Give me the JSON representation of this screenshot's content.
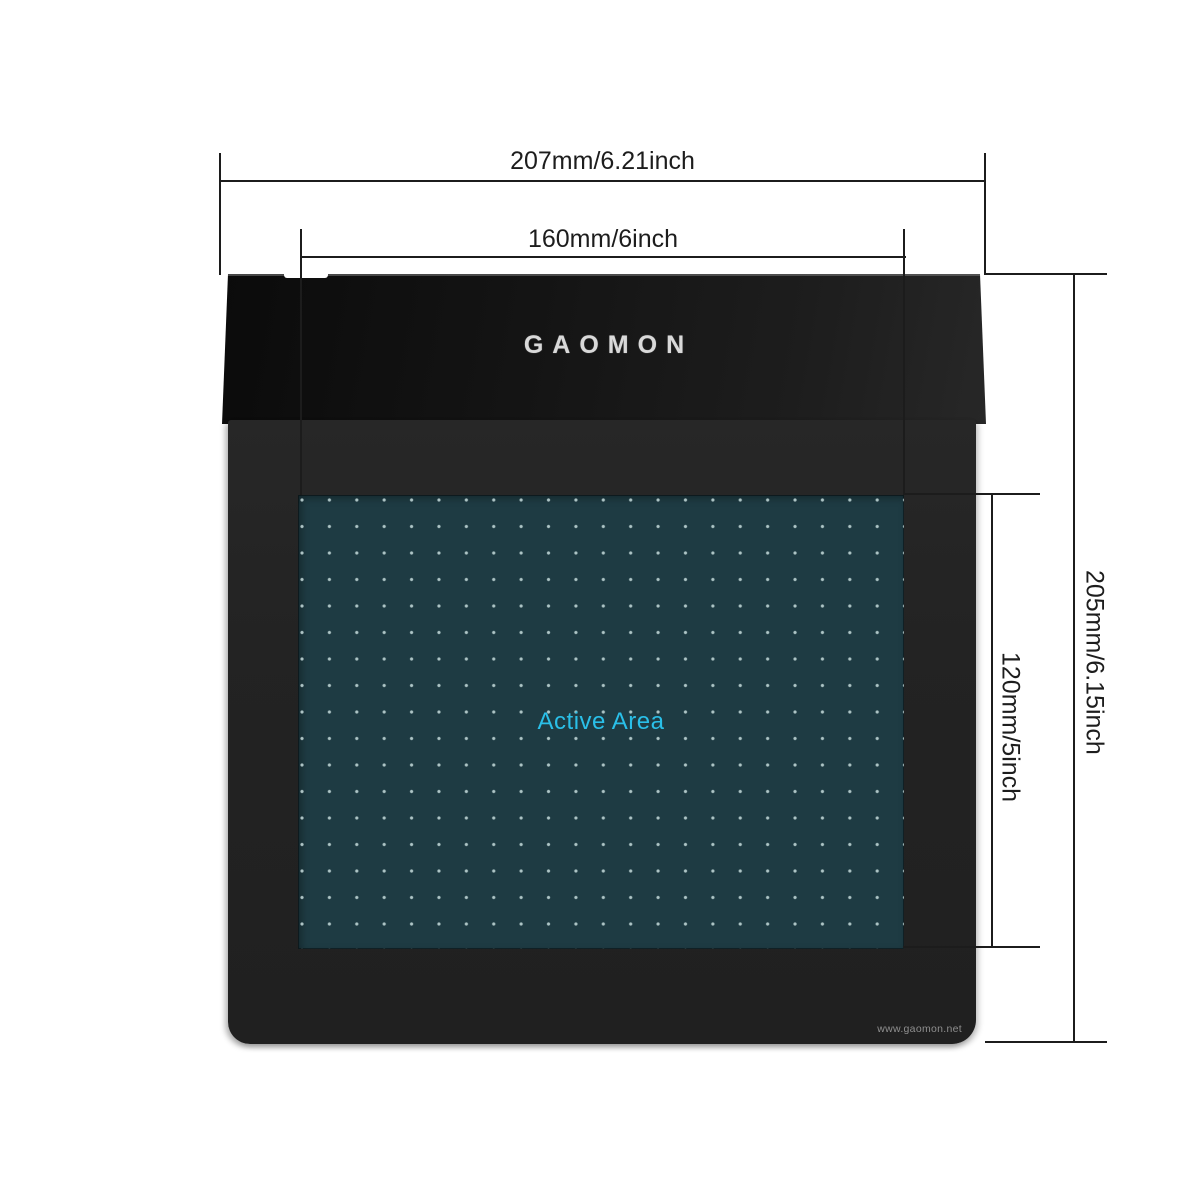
{
  "diagram_title": "tablet-dimension-diagram",
  "brand": {
    "logo_text": "GAOMON",
    "website": "www.gaomon.net"
  },
  "tablet": {
    "active_area_label": "Active Area"
  },
  "dimensions": {
    "outer_width": "207mm/6.21inch",
    "active_width": "160mm/6inch",
    "outer_height": "205mm/6.15inch",
    "active_height": "120mm/5inch"
  },
  "colors": {
    "active_area_bg": "#1e3b43",
    "active_area_dots": "#c7dddd",
    "active_area_label": "#2abfe8",
    "tablet_body": "#232323",
    "tablet_flap": "#141414",
    "logo": "#d9d9d9",
    "website_text": "#8f8f8f",
    "dimension_line": "#1c1c1c",
    "background": "#ffffff"
  }
}
